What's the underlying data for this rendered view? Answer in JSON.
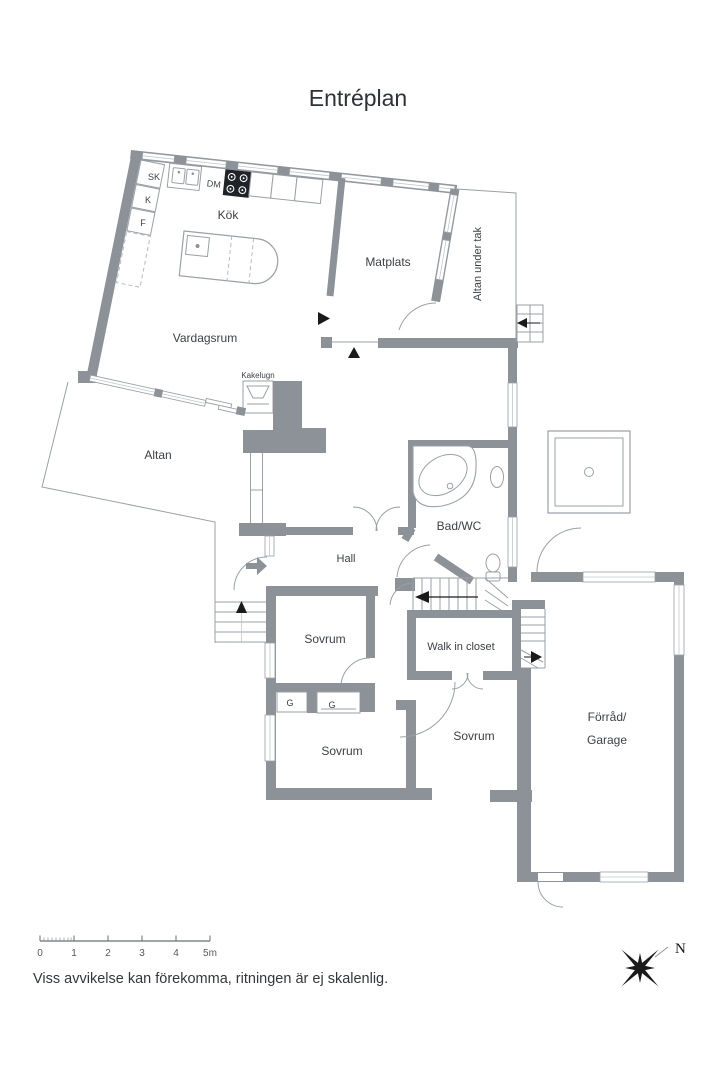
{
  "title": "Entréplan",
  "rooms": {
    "kok": "Kök",
    "matplats": "Matplats",
    "altan_under_tak": "Altan under tak",
    "vardagsrum": "Vardagsrum",
    "altan": "Altan",
    "bad_wc": "Bad/WC",
    "hall": "Hall",
    "sovrum_1": "Sovrum",
    "sovrum_2": "Sovrum",
    "sovrum_3": "Sovrum",
    "walk_in_closet": "Walk in closet",
    "forrad_garage": [
      "Förråd/",
      "Garage"
    ]
  },
  "fixtures": {
    "kakelugn": "Kakelugn",
    "sk": "SK",
    "k": "K",
    "f": "F",
    "dm": "DM",
    "g1": "G",
    "g2": "G"
  },
  "scale_bar": {
    "labels": [
      "0",
      "1",
      "2",
      "3",
      "4",
      "5m"
    ]
  },
  "compass": {
    "north_label": "N"
  },
  "footer": {
    "disclaimer": "Viss avvikelse kan förekomma, ritningen är ej skalenlig."
  },
  "colors": {
    "wall": "#8d9298",
    "line": "#9aa0a6",
    "text": "#3c4147"
  }
}
